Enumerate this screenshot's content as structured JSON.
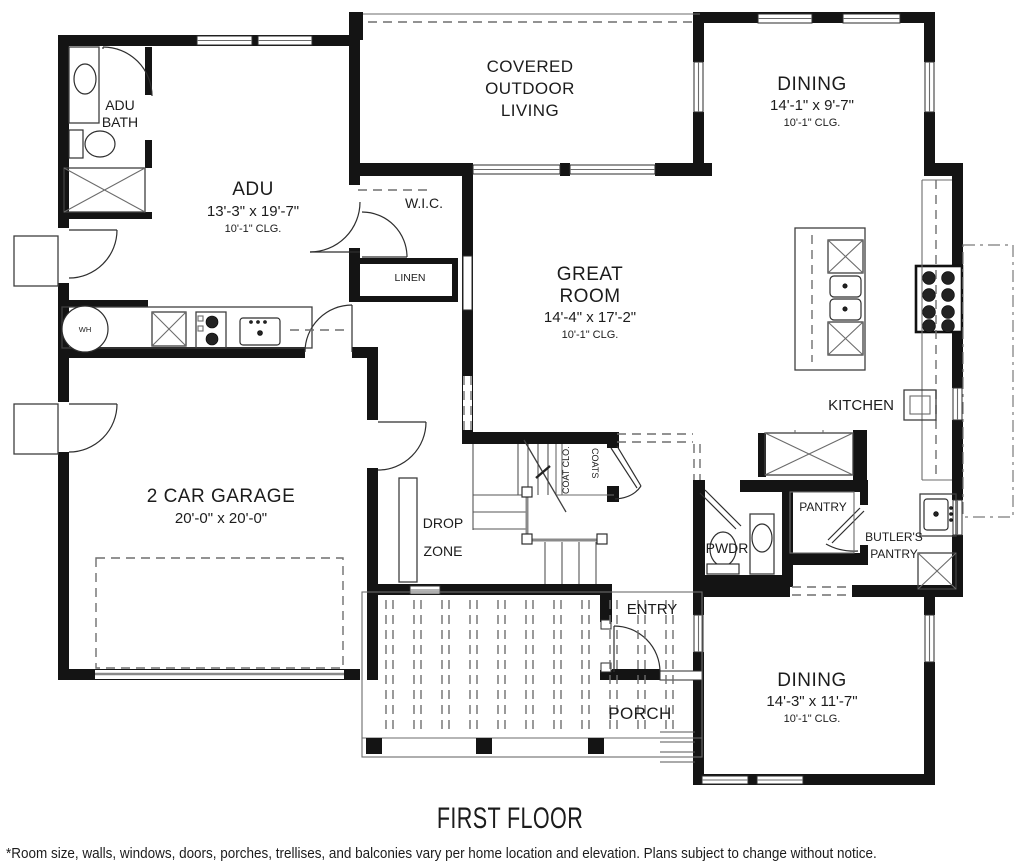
{
  "plan": {
    "title": "FIRST FLOOR",
    "disclaimer": "*Room size, walls, windows, doors, porches, trellises, and balconies vary per home location and elevation. Plans subject to change without notice.",
    "colors": {
      "walls": "#141414",
      "background": "#ffffff",
      "thin_lines": "#3f3f3f",
      "dashed_lines": "#6e6e6e"
    },
    "rooms": {
      "adu_bath": {
        "line1": "ADU",
        "line2": "BATH"
      },
      "adu": {
        "name": "ADU",
        "dims": "13'-3\" x 19'-7\"",
        "ceiling": "10'-1\" CLG."
      },
      "covered_outdoor_living": {
        "line1": "COVERED",
        "line2": "OUTDOOR",
        "line3": "LIVING"
      },
      "dining_top": {
        "name": "DINING",
        "dims": "14'-1\" x 9'-7\"",
        "ceiling": "10'-1\" CLG."
      },
      "wic": {
        "name": "W.I.C."
      },
      "linen": {
        "name": "LINEN"
      },
      "great_room": {
        "line1": "GREAT",
        "line2": "ROOM",
        "dims": "14'-4\" x 17'-2\"",
        "ceiling": "10'-1\" CLG."
      },
      "kitchen": {
        "name": "KITCHEN"
      },
      "garage": {
        "name": "2 CAR GARAGE",
        "dims": "20'-0\" x 20'-0\""
      },
      "drop_zone": {
        "line1": "DROP",
        "line2": "ZONE"
      },
      "coat_closet": {
        "label_left": "COAT CLO.",
        "label_right": "COATS"
      },
      "pwdr": {
        "name": "PWDR"
      },
      "pantry": {
        "name": "PANTRY"
      },
      "butlers_pantry": {
        "line1": "BUTLER'S",
        "line2": "PANTRY"
      },
      "entry": {
        "name": "ENTRY"
      },
      "porch": {
        "name": "PORCH"
      },
      "dining_bottom": {
        "name": "DINING",
        "dims": "14'-3\" x 11'-7\"",
        "ceiling": "10'-1\" CLG."
      }
    },
    "fixtures": {
      "water_heater": "WH"
    }
  }
}
